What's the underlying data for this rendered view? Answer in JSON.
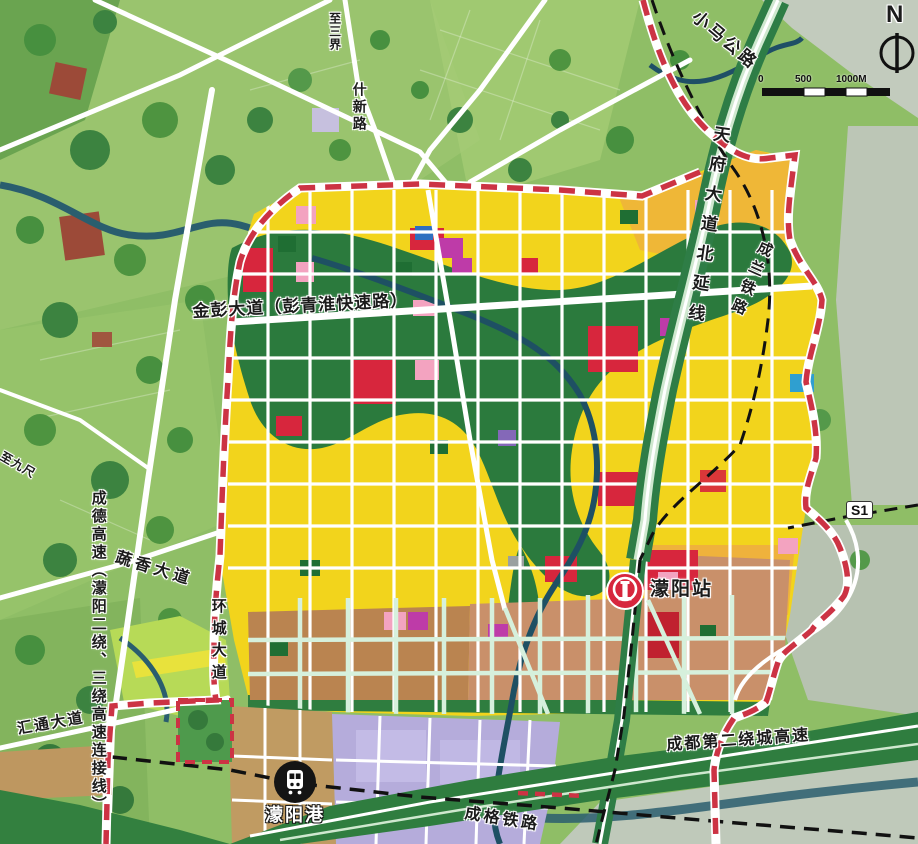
{
  "labels": {
    "xiaoma_road": "小马公路",
    "tianfu_avenue": "天府大道北延线",
    "chenglan_railway": "成兰铁路",
    "shixin_road": "什新路",
    "zhi_sanjie": "至三界",
    "zhi_jiuchi": "至九尺",
    "jinpeng_avenue": "金彭大道（彭青淮快速路）",
    "chengde_expressway": "成德高速（濛阳二绕、三绕高速连接线）",
    "shuxiang_avenue": "蔬香大道",
    "huancheng_avenue": "环城大道",
    "huitong_avenue": "汇通大道",
    "second_ring_expressway": "成都第二绕城高速",
    "chengge_railway": "成格铁路",
    "s1_line": "S1"
  },
  "stations": {
    "mengyang_station": "濛阳站",
    "mengyang_port": "濛阳港"
  },
  "compass": {
    "north": "N"
  },
  "scale_bar": {
    "start": "0",
    "mid": "500",
    "end": "1000M"
  },
  "palette": {
    "field_green": "#8FBE66",
    "forest_green": "#3F8A42",
    "grey_urban": "#C0CABA",
    "river_teal": "#235D70",
    "road_white": "#FFFFFF",
    "expressway_green": "#2E7D46",
    "zone_yellow": "#F2D41C",
    "zone_amber": "#EFB23C",
    "zone_brown": "#BA8450",
    "zone_salmon": "#C9906A",
    "zone_lavender": "#B5ACDB",
    "zone_tan": "#C09B62",
    "zone_red": "#D7263D",
    "zone_pink": "#F3A3C0",
    "zone_magenta": "#BE3BA8",
    "zone_blue": "#2F6FC0",
    "park_green": "#2B7A3D",
    "boundary_red": "#CC3344",
    "railway_black": "#111111",
    "mint_road": "#D6F0DC"
  }
}
